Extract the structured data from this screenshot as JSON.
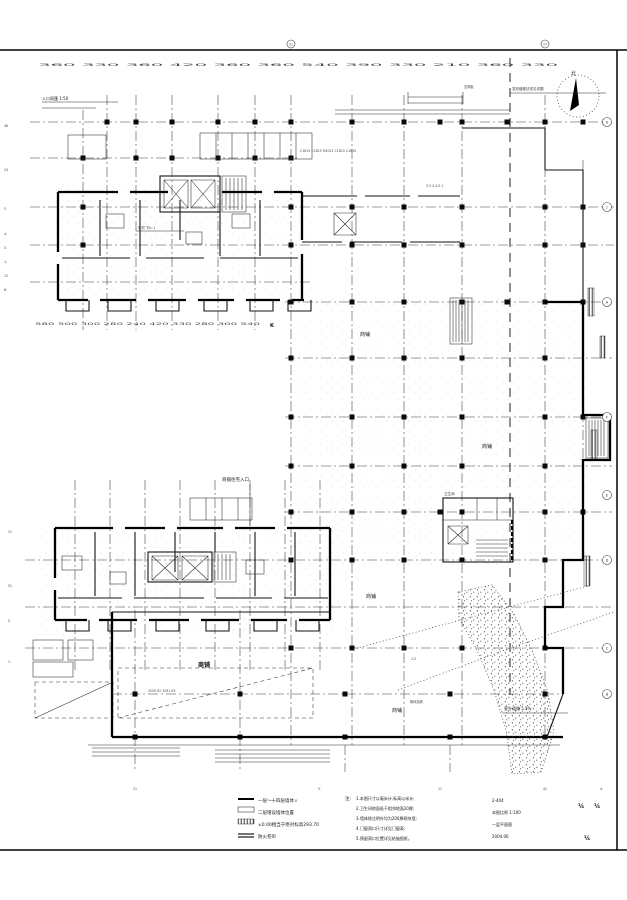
{
  "compass": {
    "north": "北"
  },
  "axes": {
    "top_dims": "360 330 360 420 360 360 540 390 330 210 360 330",
    "mid_dims": "580 500 300 280 240 420 330 280 300 540",
    "mid_axis_k": "K",
    "bottom_dims_1": "21",
    "bottom_dims_2": "5.",
    "bottom_dims_3": "11",
    "bottom_dims_4": "41",
    "bottom_dims_5": "4.",
    "bottom_sub": "8",
    "top_bubble_left": "21",
    "top_bubble_right": "27",
    "right_bubbles": [
      "K",
      "J",
      "H",
      "F",
      "E",
      "D",
      "C",
      "B"
    ],
    "left_tokens": [
      "46",
      "24",
      "5",
      "4.",
      "3.",
      "1:",
      "12",
      "8:"
    ],
    "left_lower_tokens": [
      "11",
      "51",
      "5.",
      "1."
    ]
  },
  "rooms": {
    "shop": "商铺",
    "hall_shop": "商铺",
    "toilet": "卫生间"
  },
  "annotations": {
    "canopy_note": "入口雨篷 1:50",
    "joint_note": "变形缝做法详见详图",
    "ac_note": "空调板",
    "window_row": "C1815 C1815 M1021 C1815 C1815",
    "dim_cluster": "3.3 2.4 5.1",
    "shutter_note": "卷帘门FJL-1",
    "entrance_note": "商铺住宅入口",
    "core_dims": "3250.92 3291.63",
    "road_note": "室外道路 5.5%",
    "slope_ratio": "1:2",
    "retaining_note": "砌体挡墙"
  },
  "notes_left": {
    "item1": "一层～十四层墙体",
    "item2": "二层增设墙体位置",
    "item3": "±0.00相当于绝对标高293.70",
    "item4": "防火卷帘"
  },
  "notes_center": {
    "title": "注:",
    "line1": "1.本图尺寸以毫米计,标高以米计;",
    "line2": "2.卫生间地面低于相邻地面20厚;",
    "line3": "3.墙体除注明外均为200厚砌块墙;",
    "line4": "4.门窗洞口尺寸详见门窗表;",
    "line5": "5.预留洞口位置详见结施图纸。"
  },
  "notes_right": {
    "line1": "2-404",
    "line2": "本图比例 1:100",
    "line3": "一层平面图",
    "line4": "2004.06",
    "frac1": "¼",
    "frac2": "¼",
    "frac3": "¼"
  }
}
